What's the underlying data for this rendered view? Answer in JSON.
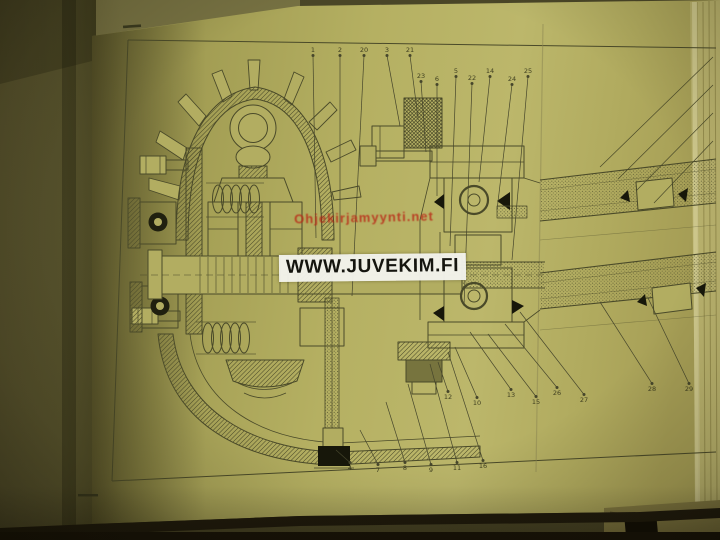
{
  "watermarks": {
    "red_text": "Ohjekirjamyynti.net",
    "white_text": "WWW.JUVEKIM.FI"
  },
  "colors": {
    "page": "#b5b05f",
    "ink": "#46462a",
    "red_watermark": "#ba2816",
    "backdrop": "#57532c"
  },
  "figure": {
    "callouts": [
      {
        "label": "1",
        "x": 313,
        "y": 52,
        "tx": 316,
        "ty": 238
      },
      {
        "label": "2",
        "x": 340,
        "y": 52,
        "tx": 340,
        "ty": 260
      },
      {
        "label": "20",
        "x": 364,
        "y": 52,
        "tx": 352,
        "ty": 296
      },
      {
        "label": "3",
        "x": 387,
        "y": 52,
        "tx": 400,
        "ty": 126
      },
      {
        "label": "21",
        "x": 410,
        "y": 52,
        "tx": 418,
        "ty": 118
      },
      {
        "label": "23",
        "x": 421,
        "y": 78,
        "tx": 426,
        "ty": 152
      },
      {
        "label": "6",
        "x": 437,
        "y": 81,
        "tx": 437,
        "ty": 196
      },
      {
        "label": "5",
        "x": 456,
        "y": 73,
        "tx": 450,
        "ty": 246
      },
      {
        "label": "22",
        "x": 472,
        "y": 80,
        "tx": 464,
        "ty": 306
      },
      {
        "label": "14",
        "x": 490,
        "y": 73,
        "tx": 479,
        "ty": 182
      },
      {
        "label": "24",
        "x": 512,
        "y": 81,
        "tx": 497,
        "ty": 210
      },
      {
        "label": "25",
        "x": 528,
        "y": 73,
        "tx": 512,
        "ty": 260
      },
      {
        "label": "12",
        "x": 448,
        "y": 399,
        "tx": 438,
        "ty": 362
      },
      {
        "label": "10",
        "x": 477,
        "y": 405,
        "tx": 455,
        "ty": 347
      },
      {
        "label": "13",
        "x": 511,
        "y": 397,
        "tx": 470,
        "ty": 332
      },
      {
        "label": "15",
        "x": 536,
        "y": 404,
        "tx": 488,
        "ty": 334
      },
      {
        "label": "26",
        "x": 557,
        "y": 395,
        "tx": 505,
        "ty": 324
      },
      {
        "label": "27",
        "x": 584,
        "y": 402,
        "tx": 520,
        "ty": 312
      },
      {
        "label": "28",
        "x": 652,
        "y": 391,
        "tx": 600,
        "ty": 302
      },
      {
        "label": "29",
        "x": 689,
        "y": 391,
        "tx": 648,
        "ty": 298
      },
      {
        "label": "4",
        "x": 350,
        "y": 470,
        "tx": 336,
        "ty": 450
      },
      {
        "label": "7",
        "x": 378,
        "y": 472,
        "tx": 360,
        "ty": 430
      },
      {
        "label": "8",
        "x": 405,
        "y": 470,
        "tx": 386,
        "ty": 402
      },
      {
        "label": "9",
        "x": 431,
        "y": 472,
        "tx": 408,
        "ty": 384
      },
      {
        "label": "11",
        "x": 457,
        "y": 470,
        "tx": 430,
        "ty": 364
      },
      {
        "label": "16",
        "x": 483,
        "y": 468,
        "tx": 448,
        "ty": 352
      }
    ]
  }
}
